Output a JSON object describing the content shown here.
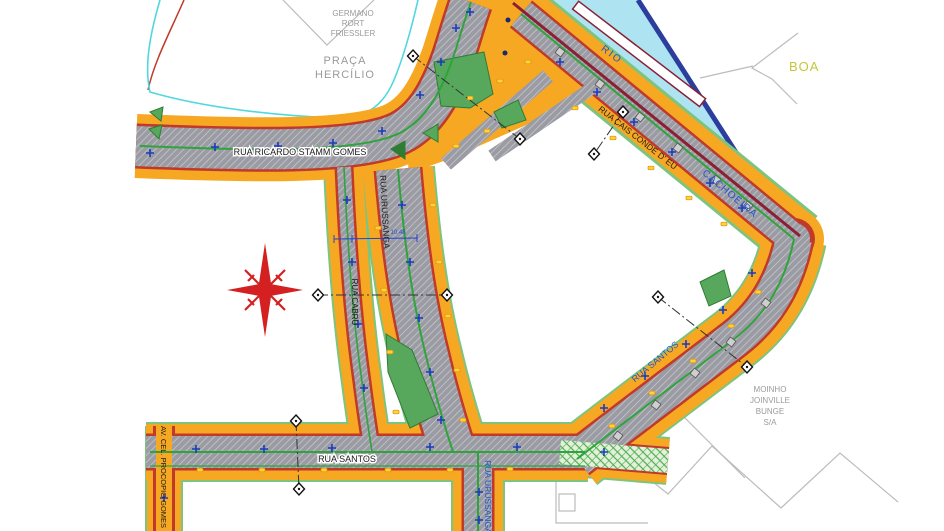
{
  "map": {
    "title": "Urban street plan - Joinville riverside area",
    "labels": {
      "praca_line1": "PRAÇA",
      "praca_line2": "HERCÍLIO",
      "germano_line1": "GERMANO",
      "germano_line2": "RORT",
      "germano_line3": "FRIESSLER",
      "rio": "RIO",
      "cachoeira": "CACHOEIRA",
      "boa": "BOA",
      "rua_ricardo": "RUA RICARDO STAMM GOMES",
      "rua_urussanga_mid": "RUA URUSSANGA",
      "rua_cabru": "RUA CABRU",
      "rua_cais": "RUA CAIS CONDE D' EU",
      "rua_santos_h": "RUA SANTOS",
      "rua_santos_d": "RUA SANTOS",
      "rua_urussanga_bottom": "RUA URUSSANGA",
      "av_procopio": "AV. CEL. PROCOPIO GOMES",
      "moinho_line1": "MOINHO",
      "moinho_line2": "JOINVILLE",
      "moinho_line3": "BUNGE",
      "moinho_line4": "S/A",
      "dim_value": "10.48"
    },
    "colors": {
      "road": "#9B9BA3",
      "road_hatch": "#C6C7CC",
      "sidewalk": "#F7A823",
      "curb": "#C0392B",
      "quay": "#8B2035",
      "river_fill": "#AEE4F2",
      "river_border": "#2B3E9E",
      "green_line": "#2FA43C",
      "island": "#57A85C",
      "island_dark": "#2E7D32",
      "cyan_line": "#4FD8DF",
      "compass": "#D42020",
      "marker_blue": "#1A3BBF",
      "label_blue": "#2255CC",
      "label_gray": "#9A9A9A",
      "boa_text": "#C6C63A",
      "property_line": "#BCBCBC",
      "lamp": "#FFD23F"
    }
  }
}
